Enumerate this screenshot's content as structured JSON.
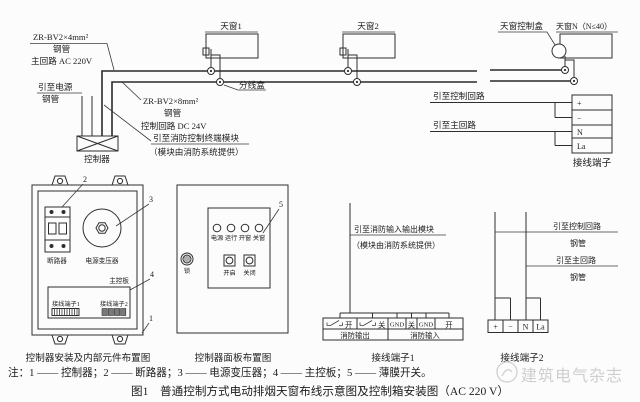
{
  "colors": {
    "ink": "#2e2e2e",
    "background": "#fcfcfc",
    "watermark": "#c7c7c7"
  },
  "wiring": {
    "main_spec": "ZR-BV2×4mm²",
    "main_conduit": "钢管",
    "main_circuit": "主回路 AC 220V",
    "to_power": "引至电源",
    "power_conduit": "钢管",
    "controller_label": "控制器",
    "ctrl_spec": "ZR-BV2×8mm²",
    "ctrl_conduit": "钢管",
    "ctrl_circuit": "控制回路 DC 24V",
    "to_fire_module_line1": "引至消防控制终端模块",
    "to_fire_module_line2": "（模块由消防系统提供）",
    "skylight1": "天窗1",
    "skylight2": "天窗2",
    "skylight_n": "天窗N（N≤40）",
    "skylight_ctrl_box": "天窗控制盒",
    "junction_box": "分线盒",
    "to_control_circuit": "引至控制回路",
    "to_main_circuit": "引至主回路",
    "terminal_caption": "接线端子",
    "terminal_cells": [
      "+",
      "−",
      "N",
      "La"
    ]
  },
  "cabinet": {
    "caption": "控制器安装及内部元件布置图",
    "breaker_label": "断路器",
    "transformer_label": "电源变压器",
    "board_label": "主控板",
    "terminal1_label": "接线端子1",
    "terminal2_label": "接线端子2",
    "callout_1": "1",
    "callout_2": "2",
    "callout_3": "3",
    "callout_4": "4"
  },
  "panel": {
    "caption": "控制器面板布置图",
    "lights": [
      "电源",
      "运行",
      "开窗",
      "关窗"
    ],
    "buttons": [
      "开启",
      "关闭"
    ],
    "lock_label": "锁",
    "callout_5": "5"
  },
  "terminal1": {
    "caption": "接线端子1",
    "lead_line1": "引至消防输入输出模块",
    "lead_line2": "（模块由消防系统提供）",
    "cells": [
      "开",
      "关",
      "GND",
      "关",
      "GND",
      "开"
    ],
    "group_output": "消防输出",
    "group_input": "消防输入"
  },
  "terminal2": {
    "caption": "接线端子2",
    "lead_control": "引至控制回路",
    "conduit1": "钢管",
    "lead_main": "引至主回路",
    "conduit2": "钢管",
    "cells": [
      "+",
      "−",
      "N",
      "La"
    ]
  },
  "footer": {
    "note": "注：1 —— 控制器；2 —— 断路器；3 —— 电源变压器；4 —— 主控板；5 —— 薄膜开关。",
    "figure_caption": "图1　普通控制方式电动排烟天窗布线示意图及控制箱安装图（AC 220 V）",
    "watermark": "建筑电气杂志"
  }
}
